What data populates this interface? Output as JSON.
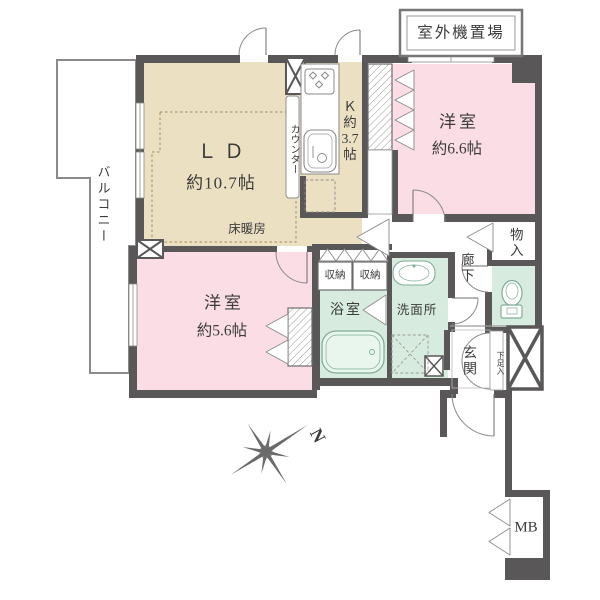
{
  "colors": {
    "wall": "#595757",
    "living_kitchen_floor": "#ECE0C3",
    "bedroom_floor": "#FBDDE5",
    "sanitary_floor": "#D7ECDF",
    "balcony_outline": "#8A8A8A"
  },
  "labels": {
    "outdoor_unit": "室外機置場",
    "balcony": "バルコニー",
    "living_dining_name": "ＬＤ",
    "living_dining_size": "約10.7帖",
    "floor_heating": "床暖房",
    "kitchen_line1": "Ｋ",
    "kitchen_line2": "約",
    "kitchen_line3": "3.7",
    "kitchen_line4": "帖",
    "counter": "カウンター",
    "bedroom1_name": "洋室",
    "bedroom1_size": "約6.6帖",
    "bedroom2_name": "洋室",
    "bedroom2_size": "約5.6帖",
    "storage_left": "収納",
    "storage_right": "収納",
    "bathroom": "浴室",
    "washroom": "洗面所",
    "corridor": "廊下",
    "closet": "物入",
    "entrance": "玄関",
    "shoe_cabinet": "下足入",
    "meter_box": "MB",
    "north": "N"
  }
}
